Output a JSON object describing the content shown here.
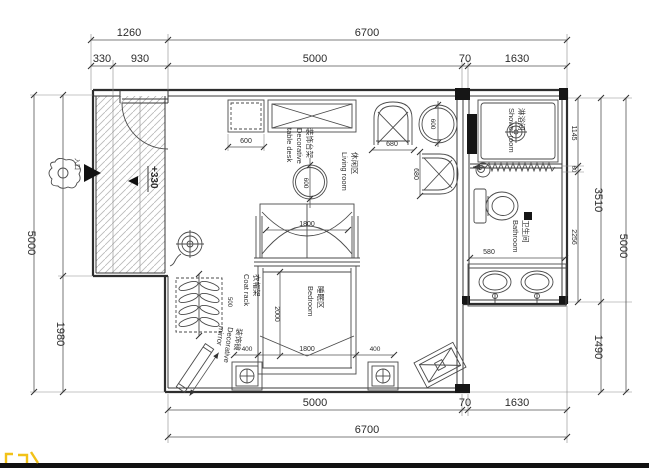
{
  "dimensions": {
    "top": {
      "entry_width": "1260",
      "total_width": "6700",
      "entry_left": "330",
      "entry_right": "930",
      "main_width": "5000",
      "wall": "70",
      "bath_width": "1630"
    },
    "bottom": {
      "main_width": "5000",
      "wall": "70",
      "bath_width": "1630",
      "total_width": "6700"
    },
    "left": {
      "total_height": "5000",
      "lower_notch": "1980"
    },
    "right": {
      "shower_depth": "1145",
      "gap": "60",
      "bath_depth": "2256",
      "bath_block": "3510",
      "lower_notch": "1490",
      "total_height": "5000"
    },
    "interior": {
      "cabinet": "600",
      "sofa_width": "680",
      "sofa_depth": "680",
      "round_chair": "600",
      "round_table": "600",
      "bed_canopy": "1800",
      "bed_length": "2000",
      "bed_width": "1800",
      "bed_side_left": "400",
      "bed_side_right": "400",
      "coat_rack": "500",
      "vanity": "580",
      "entry_level": "+330"
    }
  },
  "labels": {
    "shower": {
      "zh": "淋浴间",
      "en": "Shower room"
    },
    "bathroom": {
      "zh": "卫生间",
      "en": "Bathroom"
    },
    "living": {
      "zh": "休闲区",
      "en": "Living room"
    },
    "bedroom": {
      "zh": "睡眠区",
      "en": "Bedroom"
    },
    "coat_rack": {
      "zh": "衣帽架",
      "en": "Coat rack"
    },
    "mirror": {
      "zh": "装饰镜",
      "en1": "Decorative",
      "en2": "mirror"
    },
    "deco_table": {
      "zh": "装饰台架",
      "en1": "Decorative",
      "en2": "table desk"
    },
    "entrance": {
      "zh": "入口"
    }
  },
  "colors": {
    "line": "#3a3a3a",
    "dim_text": "#2b2b2b",
    "hatch": "#b8b8b8",
    "accent_yellow": "#f2c218",
    "bottom_bar": "#111111"
  }
}
